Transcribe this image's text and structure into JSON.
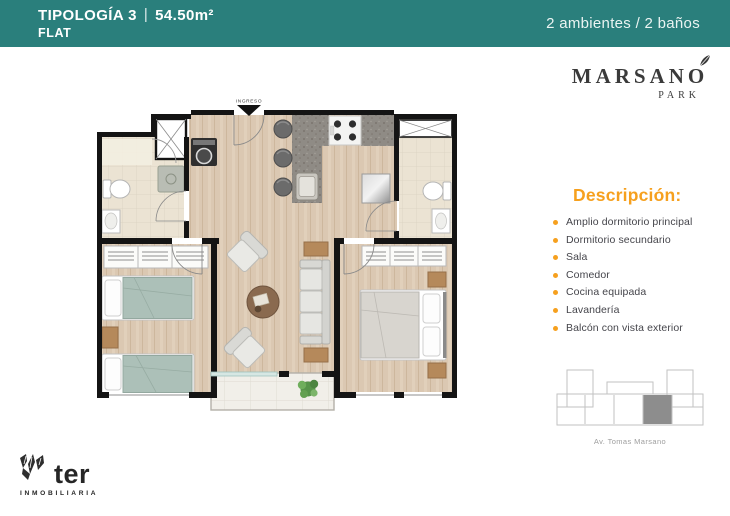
{
  "header": {
    "title": "TIPOLOGÍA  3",
    "separator": "|",
    "area": "54.50m²",
    "subtitle": "FLAT",
    "right_text": "2 ambientes / 2 baños",
    "bg_color": "#2A7F7C"
  },
  "brand": {
    "name": "MARSANO",
    "sub": "PARK"
  },
  "description": {
    "heading": "Descripción:",
    "accent_color": "#F6A01E",
    "items": [
      "Amplio dormitorio principal",
      "Dormitorio secundario",
      "Sala",
      "Comedor",
      "Cocina equipada",
      "Lavandería",
      "Balcón con vista exterior"
    ]
  },
  "plan": {
    "entry_label": "INGRESO"
  },
  "keyplan": {
    "street_label": "Av. Tomas Marsano",
    "highlight_color": "#8D8D8D"
  },
  "footer_logo": {
    "name": "ter",
    "sub": "INMOBILIARIA"
  }
}
